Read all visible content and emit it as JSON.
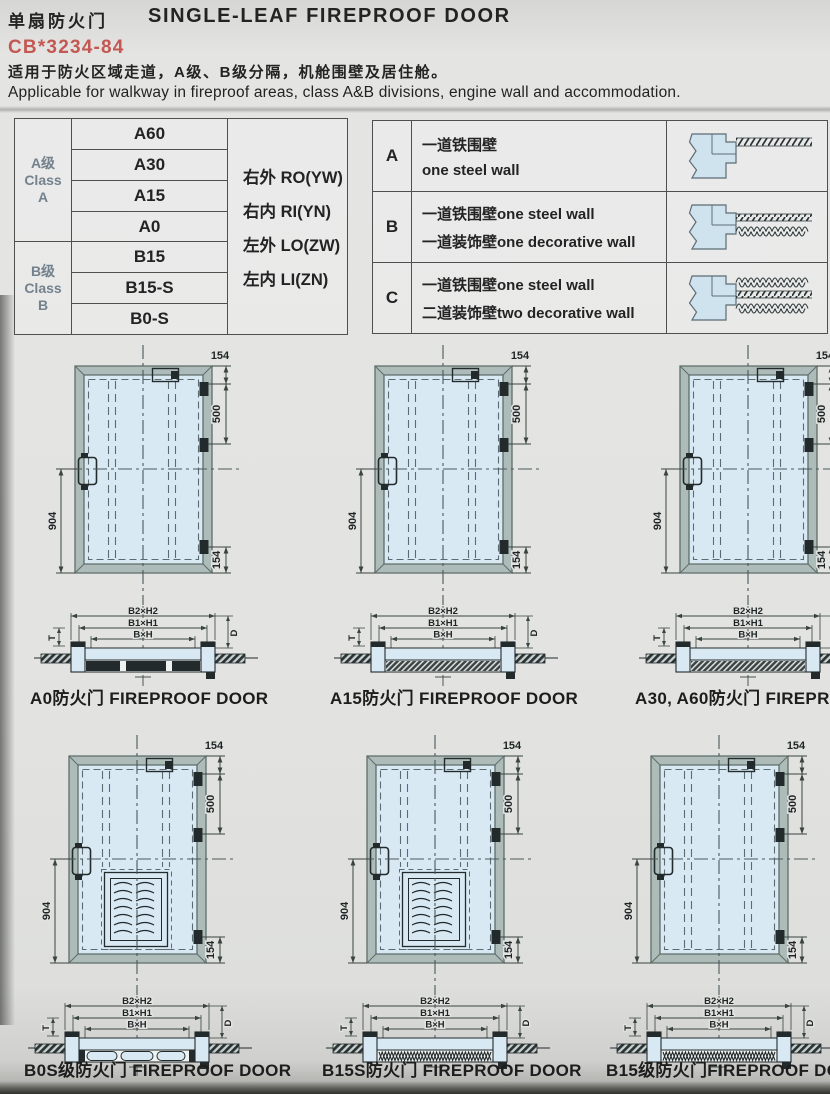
{
  "header": {
    "title_zh": "单扇防火门",
    "title_en": "SINGLE-LEAF FIREPROOF DOOR",
    "standard": "CB*3234-84",
    "desc_zh": "适用于防火区域走道，A级、B级分隔，机舱围壁及居住舱。",
    "desc_en": "Applicable for walkway in fireproof areas, class A&B divisions, engine wall and accommodation."
  },
  "class_table": {
    "groups": [
      {
        "label": [
          "A级",
          "Class",
          "A"
        ],
        "ratings": [
          "A60",
          "A30",
          "A15",
          "A0"
        ]
      },
      {
        "label": [
          "B级",
          "Class",
          "B"
        ],
        "ratings": [
          "B15",
          "B15-S",
          "B0-S"
        ]
      }
    ],
    "orientations": [
      "右外 RO(YW)",
      "右内 RI(YN)",
      "左外 LO(ZW)",
      "左内 LI(ZN)"
    ]
  },
  "wall_table": {
    "rows": [
      {
        "key": "A",
        "lines": [
          "一道铁围壁",
          "one steel wall"
        ]
      },
      {
        "key": "B",
        "lines": [
          "一道铁围壁one steel wall",
          "一道装饰壁one decorative wall"
        ]
      },
      {
        "key": "C",
        "lines": [
          "一道铁围壁one steel wall",
          "二道装饰壁two decorative wall"
        ]
      }
    ]
  },
  "dims": {
    "d154": "154",
    "d500": "500",
    "d904": "904",
    "b2h2": "B2×H2",
    "b1h1": "B1×H1",
    "bh": "B×H",
    "d": "D",
    "t": "T"
  },
  "figures": [
    {
      "caption": "A0防火门 FIREPROOF DOOR",
      "louver": false,
      "section": "a0"
    },
    {
      "caption": "A15防火门 FIREPROOF DOOR",
      "louver": false,
      "section": "a15"
    },
    {
      "caption": "A30, A60防火门 FIREPROOF DOOR",
      "louver": false,
      "section": "a60"
    },
    {
      "caption": "B0S级防火门 FIREPROOF DOOR",
      "louver": true,
      "section": "b0s"
    },
    {
      "caption": "B15S防火门 FIREPROOF DOOR",
      "louver": true,
      "section": "b15s"
    },
    {
      "caption": "B15级防火门FIREPROOF DOOR",
      "louver": false,
      "section": "b15"
    }
  ],
  "colors": {
    "accent_red": "#c0453f",
    "door_fill": "#d9e9f4",
    "frame_fill": "#aebcb9",
    "line_dark": "#222a2b"
  }
}
